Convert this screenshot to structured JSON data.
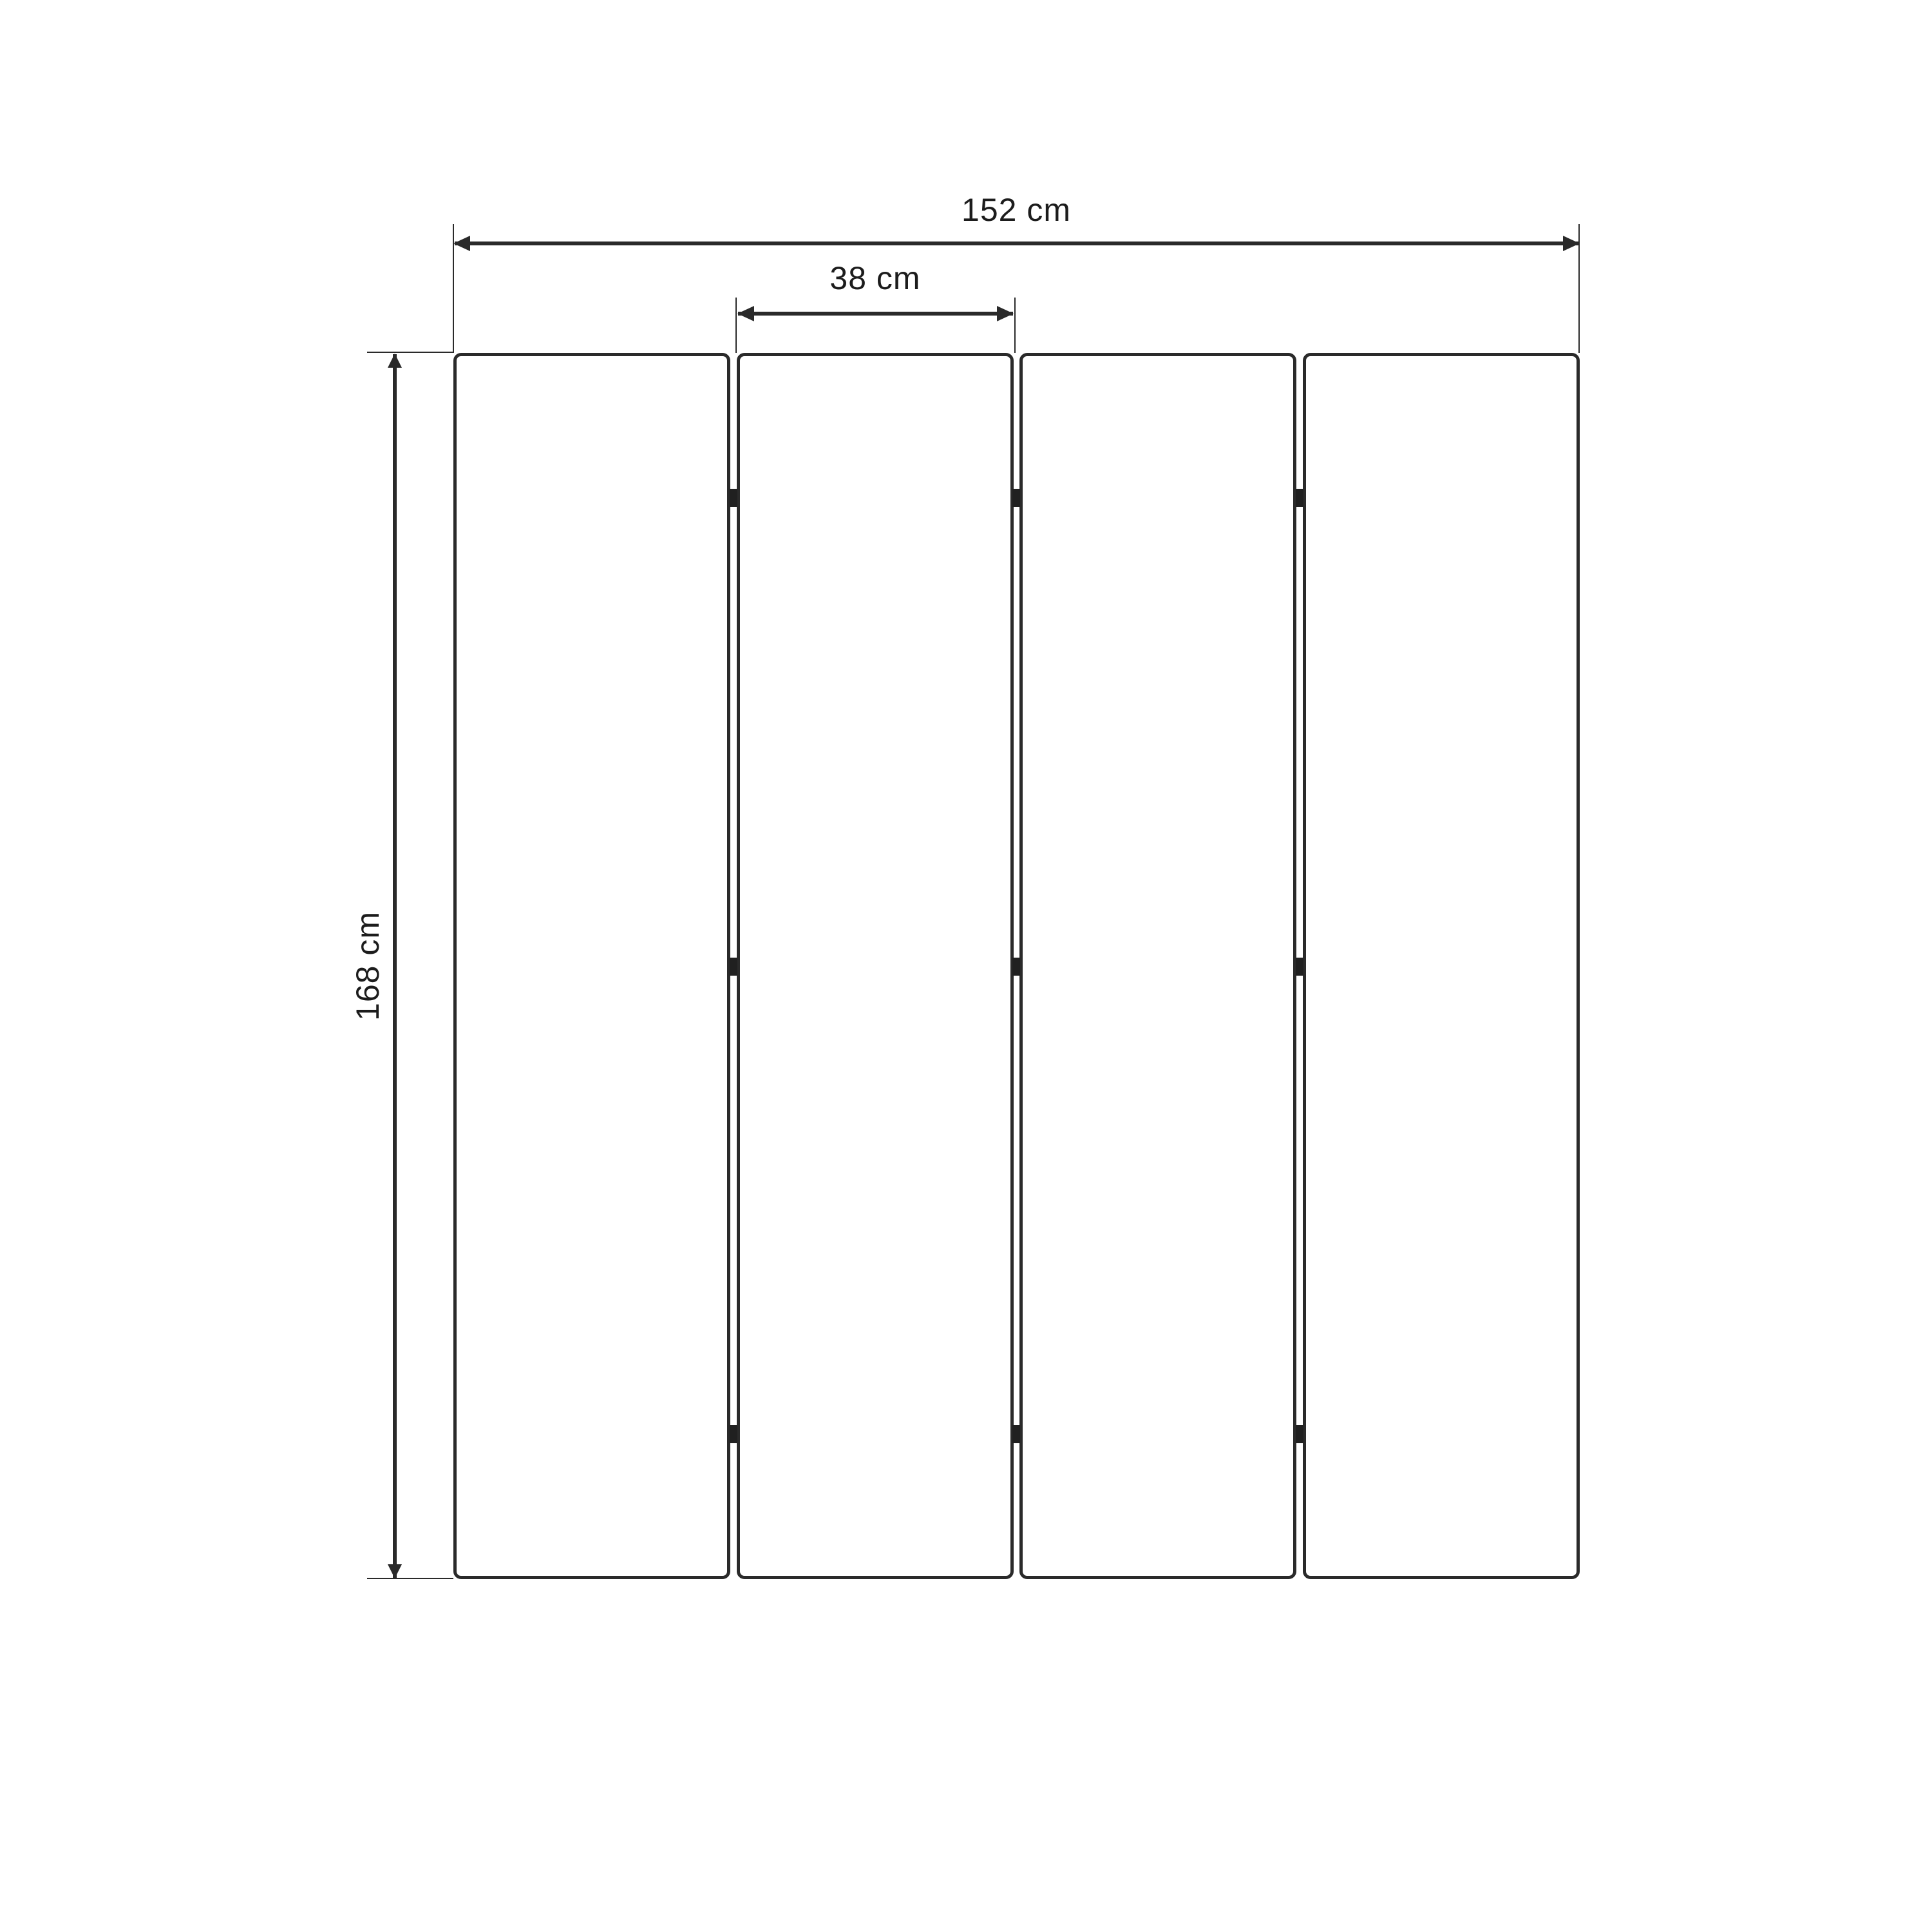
{
  "diagram": {
    "type": "furniture-dimension-drawing",
    "subject": "four-panel-folding-screen-front-view",
    "colors": {
      "background": "#ffffff",
      "line": "#2a2a2a",
      "hinge": "#202020",
      "text": "#1c1c1c"
    },
    "structure": {
      "panel_count": 4,
      "hinge_columns": 3,
      "hinges_per_column": 3
    },
    "dimensions": {
      "total_width_label": "152 cm",
      "panel_width_label": "38 cm",
      "height_label": "168 cm"
    }
  }
}
